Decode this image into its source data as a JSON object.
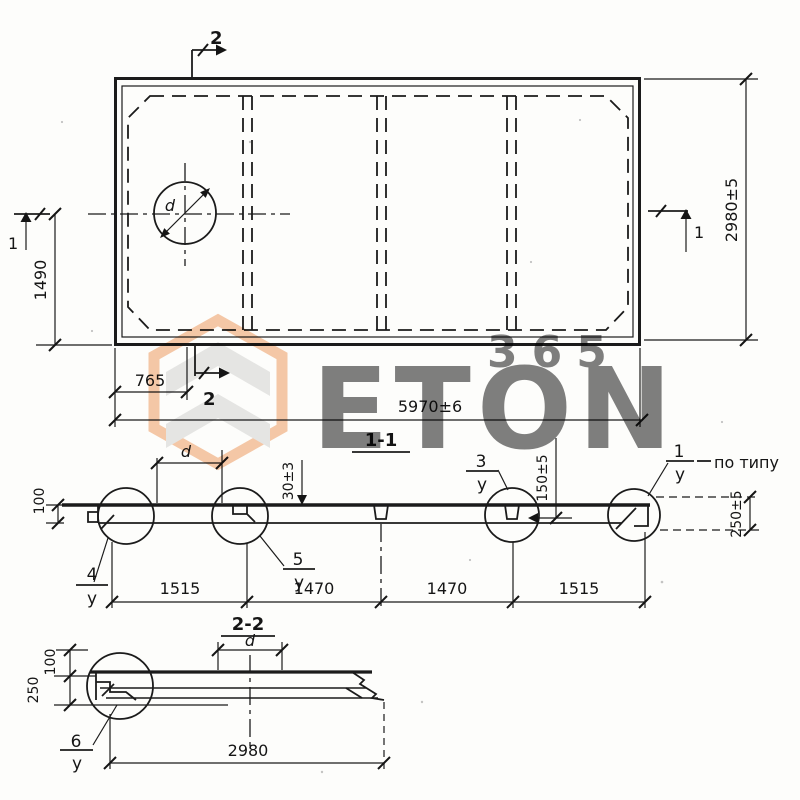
{
  "watermark": {
    "brand": "ETON",
    "number": "365"
  },
  "plan": {
    "section_marker_top": "2",
    "section_marker_bottom": "2",
    "section_marker_left": "1",
    "section_marker_right": "1",
    "dim_width": "5970±6",
    "dim_height": "2980±5",
    "dim_half_height": "1490",
    "dim_hole_offset": "765",
    "hole_diameter_label": "d"
  },
  "section1": {
    "title": "1-1",
    "dim_d": "d",
    "dim_topping": "30±3",
    "dim_key": "150±5",
    "dim_depth": "250±5",
    "dim_thickness": "100",
    "segments": [
      "1515",
      "1470",
      "1470",
      "1515"
    ],
    "detail4_num": "4",
    "detail4_den": "у",
    "detail5_num": "5",
    "detail5_den": "у",
    "detail3_num": "3",
    "detail3_den": "у",
    "detail1_num": "1",
    "detail1_den": "у",
    "note": "по типу"
  },
  "section2": {
    "title": "2-2",
    "dim_d": "d",
    "dim_100": "100",
    "dim_250": "250",
    "dim_width": "2980",
    "detail6_num": "6",
    "detail6_den": "у"
  }
}
